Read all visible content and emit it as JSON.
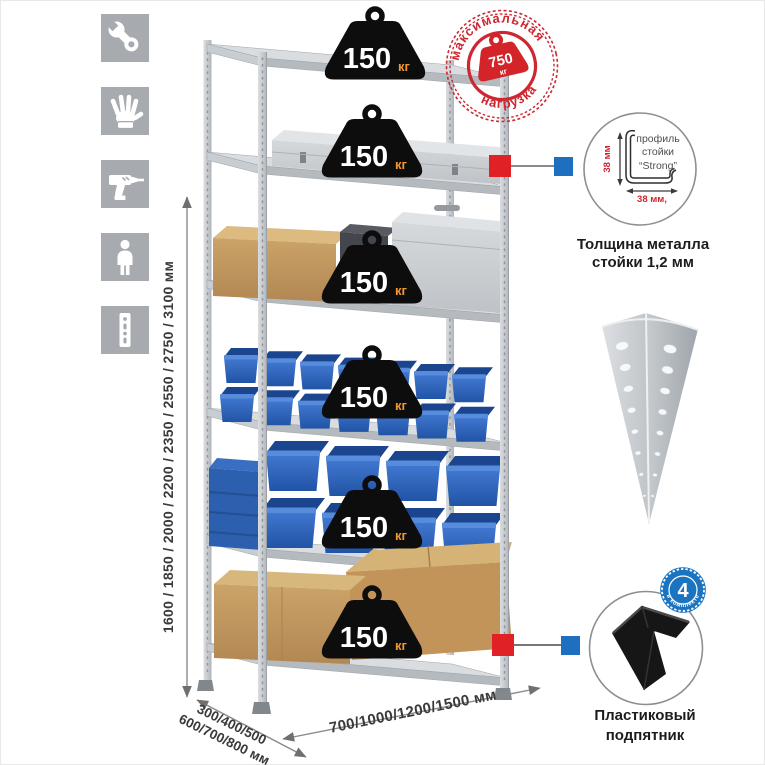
{
  "sidebar": {
    "icons": [
      {
        "name": "wrench-icon"
      },
      {
        "name": "work-gloves-icon"
      },
      {
        "name": "drill-icon"
      },
      {
        "name": "person-icon"
      },
      {
        "name": "perforated-post-icon"
      }
    ]
  },
  "rack": {
    "shelf_count": 6,
    "shelf_load_value": "150",
    "shelf_load_unit": "кг"
  },
  "max_load_stamp": {
    "line_top": "максимальная",
    "line_bottom": "нагрузка",
    "value": "750",
    "unit": "кг"
  },
  "dimensions": {
    "height": "1600 / 1850 / 2000 / 2200 / 2350 / 2550 / 2750 / 3100 мм",
    "depth_line1": "300/400/500",
    "depth_line2": "600/700/800 мм",
    "width": "700/1000/1200/1500 мм"
  },
  "profile_detail": {
    "dim_vertical": "38 мм",
    "dim_horizontal": "38 мм,",
    "label_line1": "профиль",
    "label_line2": "стойки",
    "label_line3": "“Strong”",
    "caption_line1": "Толщина металла",
    "caption_line2": "стойки 1,2 мм"
  },
  "foot_detail": {
    "badge_value": "4",
    "badge_text": "в комплекте",
    "caption_line1": "Пластиковый",
    "caption_line2": "подпятник"
  },
  "colors": {
    "accent_red": "#d3242a",
    "accent_blue": "#1e6fc0",
    "badge_black": "#0d0d0d",
    "unit_orange": "#f2992e",
    "bin_blue": "#2d63b5",
    "metal_gray": "#c9cdd1"
  }
}
